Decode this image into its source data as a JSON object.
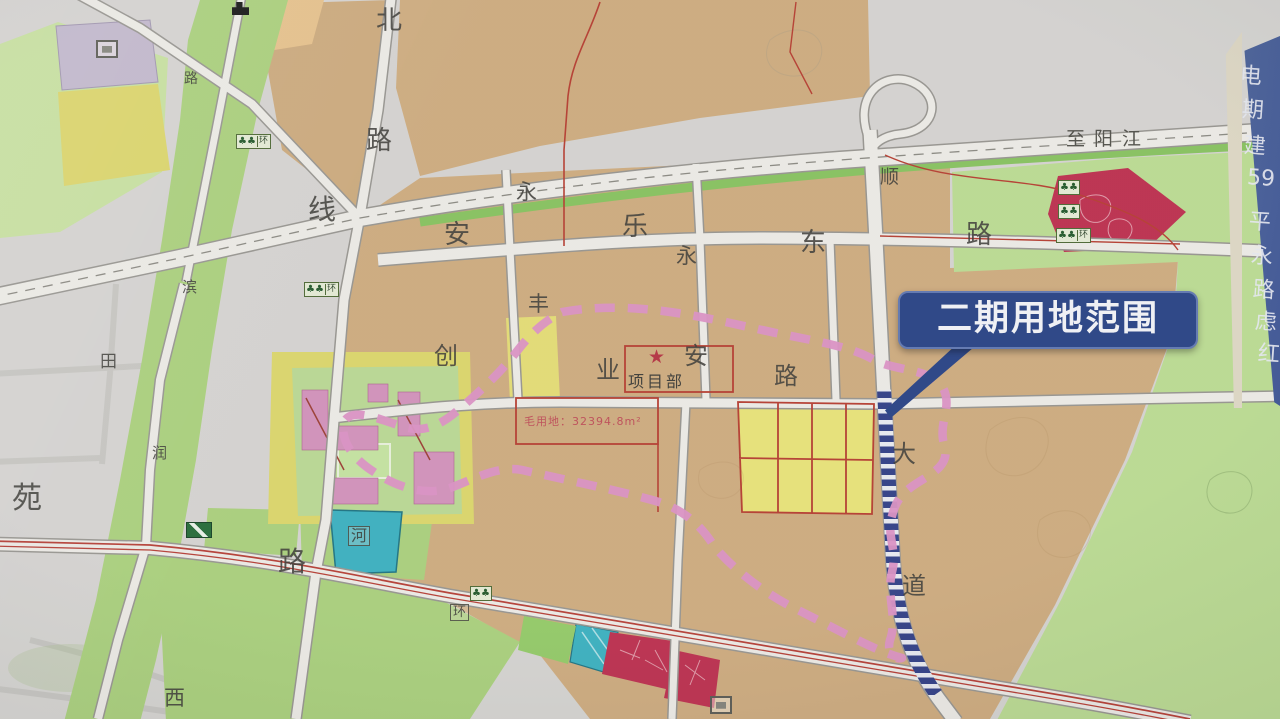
{
  "photo": {
    "subject": "urban land-use planning map photographed on site signboard"
  },
  "callout": {
    "label": "二期用地范围",
    "bg_color": "#24418c",
    "border_color": "#5d77b8"
  },
  "project_site": {
    "star": "★",
    "label": "项目部",
    "area_note": "毛用地：32394.8m²"
  },
  "highway": {
    "destination_label": "至阳江"
  },
  "sign_edge": {
    "chars": [
      "电",
      "期",
      "建",
      "59",
      "平",
      "永",
      "路",
      "虑",
      "红"
    ],
    "ys": [
      58,
      92,
      128,
      166,
      204,
      238,
      272,
      304,
      336
    ]
  },
  "map_labels": [
    {
      "t": "北",
      "x": 376,
      "y": 8,
      "fs": 26
    },
    {
      "t": "路",
      "x": 366,
      "y": 128,
      "fs": 26
    },
    {
      "t": "线",
      "x": 308,
      "y": 196,
      "fs": 28
    },
    {
      "t": "安",
      "x": 444,
      "y": 222,
      "fs": 26
    },
    {
      "t": "乐",
      "x": 622,
      "y": 214,
      "fs": 26
    },
    {
      "t": "东",
      "x": 800,
      "y": 230,
      "fs": 26
    },
    {
      "t": "路",
      "x": 966,
      "y": 222,
      "fs": 26
    },
    {
      "t": "永",
      "x": 516,
      "y": 182,
      "fs": 21
    },
    {
      "t": "永",
      "x": 676,
      "y": 246,
      "fs": 21
    },
    {
      "t": "顺",
      "x": 880,
      "y": 168,
      "fs": 19
    },
    {
      "t": "丰",
      "x": 528,
      "y": 294,
      "fs": 21
    },
    {
      "t": "创",
      "x": 434,
      "y": 344,
      "fs": 24
    },
    {
      "t": "业",
      "x": 596,
      "y": 358,
      "fs": 24
    },
    {
      "t": "安",
      "x": 684,
      "y": 344,
      "fs": 24
    },
    {
      "t": "路",
      "x": 774,
      "y": 364,
      "fs": 24
    },
    {
      "t": "大",
      "x": 892,
      "y": 442,
      "fs": 24
    },
    {
      "t": "道",
      "x": 902,
      "y": 574,
      "fs": 24
    },
    {
      "t": "路",
      "x": 278,
      "y": 548,
      "fs": 28
    },
    {
      "t": "苑",
      "x": 12,
      "y": 484,
      "fs": 30
    },
    {
      "t": "田",
      "x": 100,
      "y": 354,
      "fs": 17
    },
    {
      "t": "滨",
      "x": 182,
      "y": 280,
      "fs": 15
    },
    {
      "t": "润",
      "x": 152,
      "y": 446,
      "fs": 15
    },
    {
      "t": "西",
      "x": 164,
      "y": 688,
      "fs": 21
    },
    {
      "t": "路",
      "x": 184,
      "y": 72,
      "fs": 14
    },
    {
      "t": "河",
      "x": 348,
      "y": 526,
      "fs": 16,
      "boxed": true
    },
    {
      "t": "环",
      "x": 450,
      "y": 604,
      "fs": 13,
      "boxed": true
    }
  ],
  "icons": [
    {
      "type": "tree-sign",
      "x": 236,
      "y": 134,
      "env": "环"
    },
    {
      "type": "tree-sign",
      "x": 304,
      "y": 282,
      "env": "环"
    },
    {
      "type": "tree-sign",
      "x": 470,
      "y": 586
    },
    {
      "type": "tree-sign",
      "x": 1058,
      "y": 180
    },
    {
      "type": "tree-sign",
      "x": 1058,
      "y": 204
    },
    {
      "type": "tree-sign",
      "x": 1056,
      "y": 228,
      "env": "环"
    },
    {
      "type": "arrow-sign",
      "x": 186,
      "y": 522
    },
    {
      "type": "building-icon",
      "x": 232,
      "y": 2
    },
    {
      "type": "box-icon",
      "x": 96,
      "y": 40
    },
    {
      "type": "box-icon",
      "x": 710,
      "y": 696
    }
  ],
  "colors": {
    "parcel_tan": "#d2ab79",
    "parcel_yellow": "#e5de69",
    "parcel_green": "#a7d274",
    "parcel_light_green": "#b9dd8b",
    "parcel_teal": "#2fb3c4",
    "parcel_crimson": "#c92a4e",
    "parcel_purple": "#c3b7cf",
    "boundary_pink": "#e18fc7",
    "road_fill": "#edebe6",
    "red_line": "#c0392b",
    "construction_navy": "#2e3e8e"
  }
}
